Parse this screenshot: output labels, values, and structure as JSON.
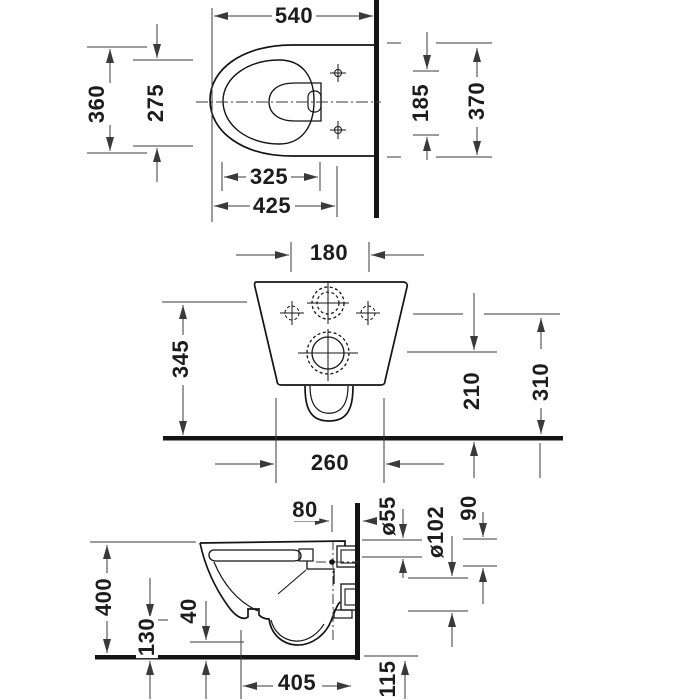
{
  "drawing": {
    "kind": "technical installation drawing, three orthographic views",
    "unit_system": "mm",
    "colors": {
      "background": "#ffffff",
      "outline": "#141414",
      "dimension_lines": "#3a3a3a"
    }
  },
  "dims": {
    "top": {
      "d540": "540",
      "d360": "360",
      "d275": "275",
      "d185": "185",
      "d370": "370",
      "d325": "325",
      "d425": "425"
    },
    "front": {
      "d180": "180",
      "d345": "345",
      "d210": "210",
      "d310": "310",
      "d260": "260"
    },
    "side": {
      "d80": "80",
      "d55": "ø55",
      "d90": "90",
      "d102": "ø102",
      "d400": "400",
      "d130": "130",
      "d40": "40",
      "d405": "405",
      "d115": "115"
    }
  }
}
